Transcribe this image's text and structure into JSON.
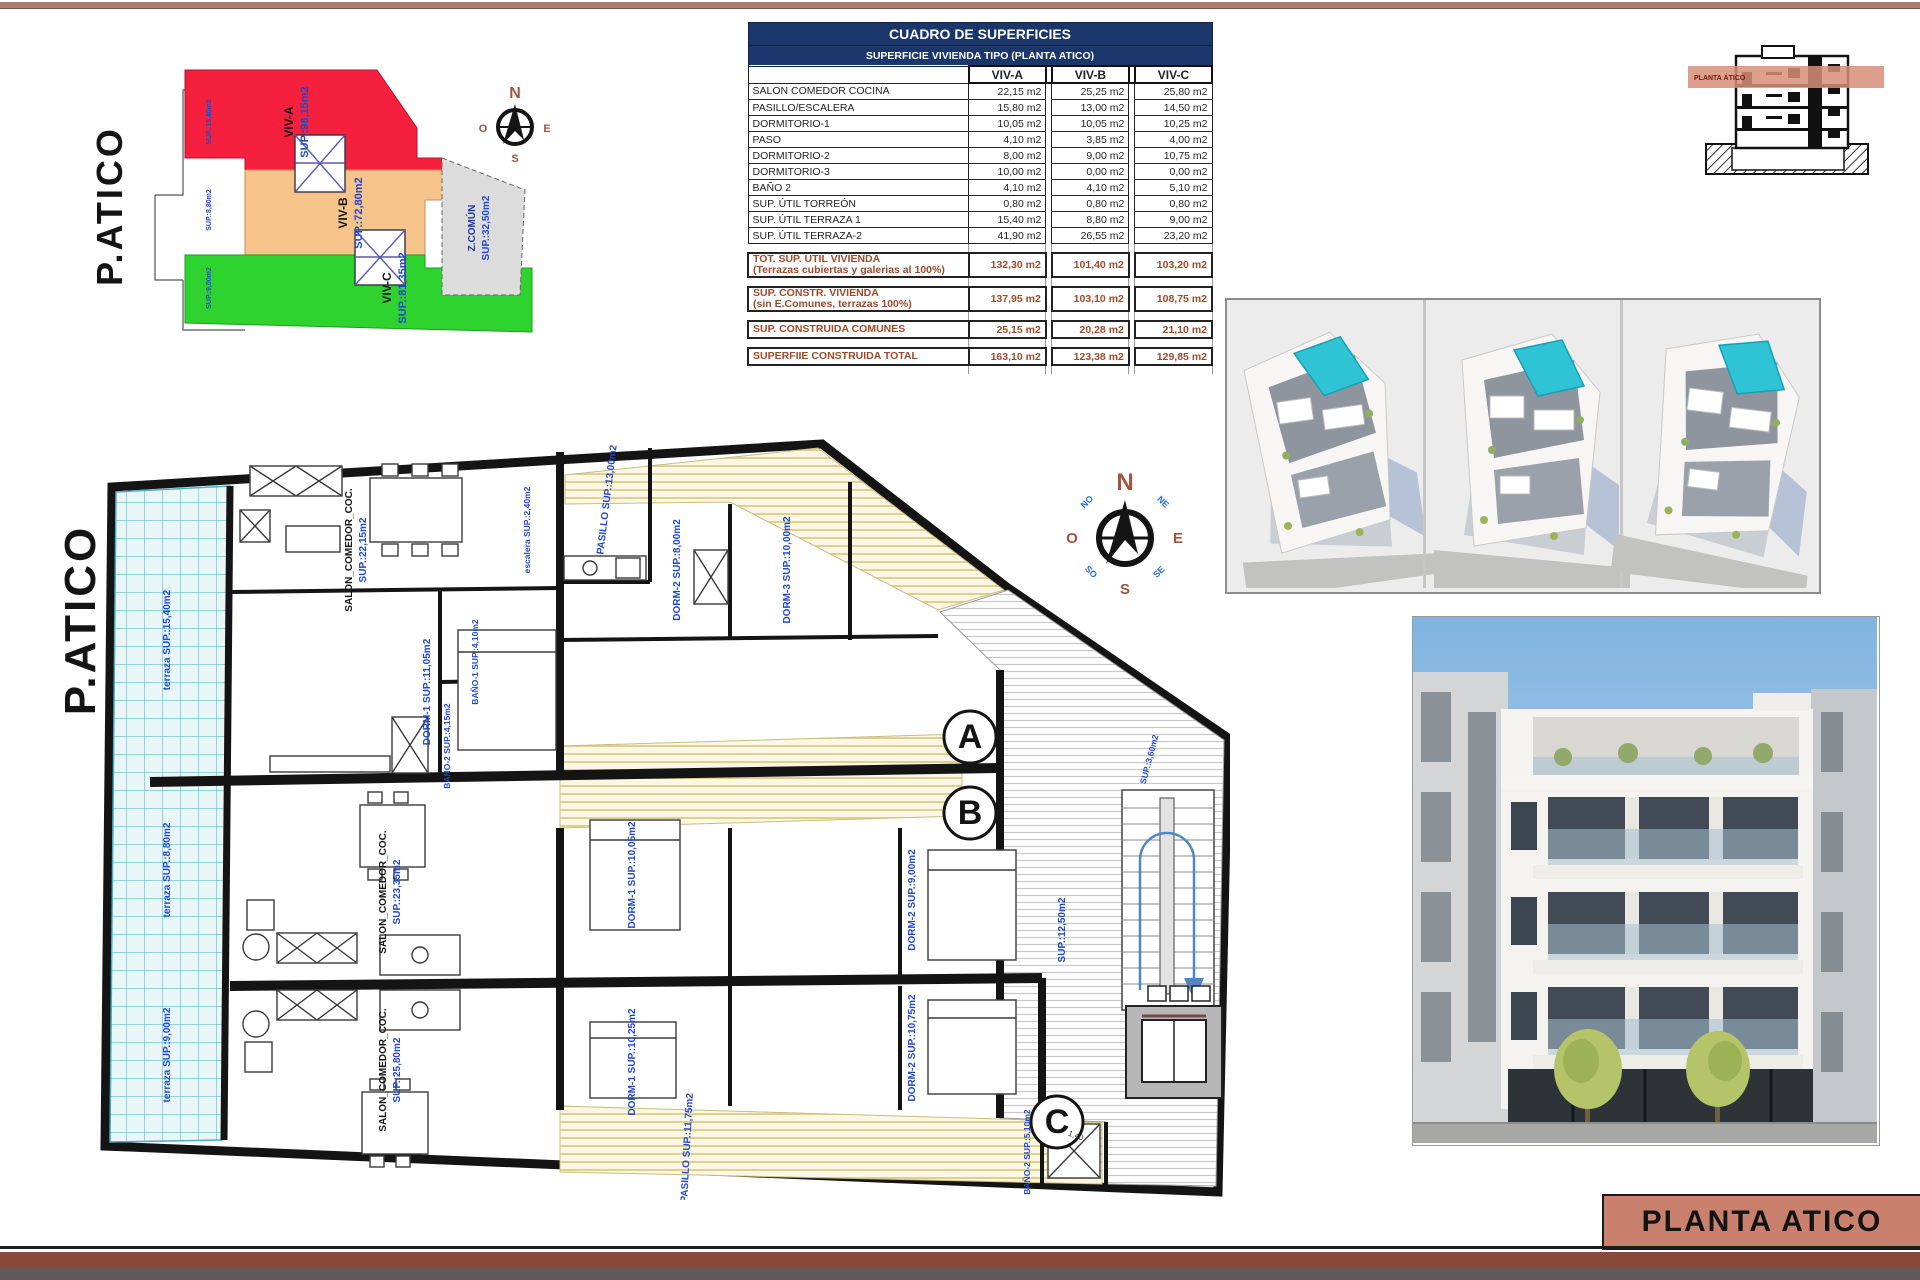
{
  "sheet": {
    "title_block_label": "PLANTA ATICO",
    "accent_color": "#c9806d",
    "header_color": "#1a366b",
    "summary_text_color": "#9e4a2b"
  },
  "site_plan": {
    "title": "P.ATICO",
    "zones": [
      {
        "name": "VIV-A",
        "sup": "SUP.:98,15m2",
        "color": "#f5203e"
      },
      {
        "name": "VIV-B",
        "sup": "SUP.:72,80m2",
        "color": "#f6c38a"
      },
      {
        "name": "VIV-C",
        "sup": "SUP.:81,35m2",
        "color": "#2fd32f"
      },
      {
        "name": "Z.COMÚN",
        "sup": "SUP.:32,50m2",
        "color": "#dcdcdc"
      }
    ],
    "edge_labels": [
      "SUP.:15,40m2",
      "SUP.:8,80m2",
      "SUP.:9,00m2"
    ]
  },
  "areas_table": {
    "title": "CUADRO DE SUPERFICIES",
    "subtitle": "SUPERFICIE VIVIENDA TIPO  (PLANTA ATICO)",
    "columns": [
      "VIV-A",
      "VIV-B",
      "VIV-C"
    ],
    "rows": [
      {
        "label": "SALON COMEDOR COCINA",
        "values": [
          "22,15 m2",
          "25,25 m2",
          "25,80 m2"
        ]
      },
      {
        "label": "PASILLO/ESCALERA",
        "values": [
          "15,80 m2",
          "13,00 m2",
          "14,50 m2"
        ]
      },
      {
        "label": "DORMITORIO-1",
        "values": [
          "10,05 m2",
          "10,05 m2",
          "10,25 m2"
        ]
      },
      {
        "label": "PASO",
        "values": [
          "4,10 m2",
          "3,85 m2",
          "4,00 m2"
        ]
      },
      {
        "label": "DORMITORIO-2",
        "values": [
          "8,00 m2",
          "9,00 m2",
          "10,75 m2"
        ]
      },
      {
        "label": "DORMITORIO-3",
        "values": [
          "10,00 m2",
          "0,00 m2",
          "0,00 m2"
        ]
      },
      {
        "label": "BAÑO 2",
        "values": [
          "4,10 m2",
          "4,10 m2",
          "5,10 m2"
        ]
      },
      {
        "label": "SUP. ÚTIL TORREÓN",
        "values": [
          "0,80 m2",
          "0,80 m2",
          "0,80 m2"
        ]
      },
      {
        "label": "SUP. ÚTIL TERRAZA 1",
        "values": [
          "15,40 m2",
          "8,80 m2",
          "9,00 m2"
        ]
      },
      {
        "label": "SUP. ÚTIL TERRAZA-2",
        "values": [
          "41,90 m2",
          "26,55 m2",
          "23,20 m2"
        ]
      }
    ],
    "summary_rows": [
      {
        "label": "TOT. SUP. UTIL VIVIENDA",
        "sublabel": "(Terrazas cubiertas y galerias al 100%)",
        "values": [
          "132,30 m2",
          "101,40 m2",
          "103,20 m2"
        ]
      },
      {
        "label": "SUP. CONSTR. VIVIENDA",
        "sublabel": "(sin E.Comunes, terrazas 100%)",
        "values": [
          "137,95 m2",
          "103,10 m2",
          "108,75 m2"
        ]
      },
      {
        "label": "SUP. CONSTRUIDA COMUNES",
        "sublabel": "",
        "values": [
          "25,15 m2",
          "20,28 m2",
          "21,10 m2"
        ]
      },
      {
        "label": "SUPERFIIE CONSTRUIDA TOTAL",
        "sublabel": "",
        "values": [
          "163,10 m2",
          "123,38 m2",
          "129,85 m2"
        ]
      }
    ]
  },
  "section_thumb": {
    "band_label": "PLANTA ÁTICO"
  },
  "compass": {
    "n": "N",
    "s": "S",
    "e": "E",
    "o": "O",
    "ne": "NE",
    "no": "NO",
    "se": "SE",
    "so": "SO"
  },
  "floor_plan": {
    "title": "P.ATICO",
    "units": [
      "A",
      "B",
      "C"
    ],
    "labels": {
      "pasillo_top": "PASILLO SUP.:13,00m2",
      "salon_a_1": "SALON_COMEDOR_COC.",
      "salon_a_2": "SUP.:22,15m2",
      "terraza_a": "terraza SUP.:15,40m2",
      "terraza_b": "terraza SUP.:8,80m2",
      "terraza_c": "terraza SUP.:9,00m2",
      "dorm1_a": "DORM-1 SUP.:11,05m2",
      "bano1_a": "BAÑO-1 SUP.:4,10m2",
      "bano2_a": "BAÑO-2 SUP.:4,15m2",
      "escalera_a": "escalera SUP.:2,40m2",
      "dorm2_a": "DORM-2 SUP.:8,00m2",
      "dorm3_a": "DORM-3 SUP.:10,00m2",
      "salon_b_1": "SALON_COMEDOR_COC.",
      "salon_b_2": "SUP.:23,35m2",
      "dorm1_b": "DORM-1 SUP.:10,05m2",
      "dorm2_b": "DORM-2 SUP.:9,00m2",
      "salon_c_1": "SALON_COMEDOR_COC.",
      "salon_c_2": "SUP.:25,80m2",
      "dorm1_c": "DORM-1 SUP.:10,25m2",
      "dorm2_c": "DORM-2 SUP.:10,75m2",
      "pasillo_c": "PASILLO SUP.:11,75m2",
      "common_hall": "SUP.:12,50m2",
      "common_entry": "SUP.:3,60m2",
      "bano2_c": "BAÑO-2 SUP.:5,10m2",
      "dim_shower": "1,40"
    }
  }
}
